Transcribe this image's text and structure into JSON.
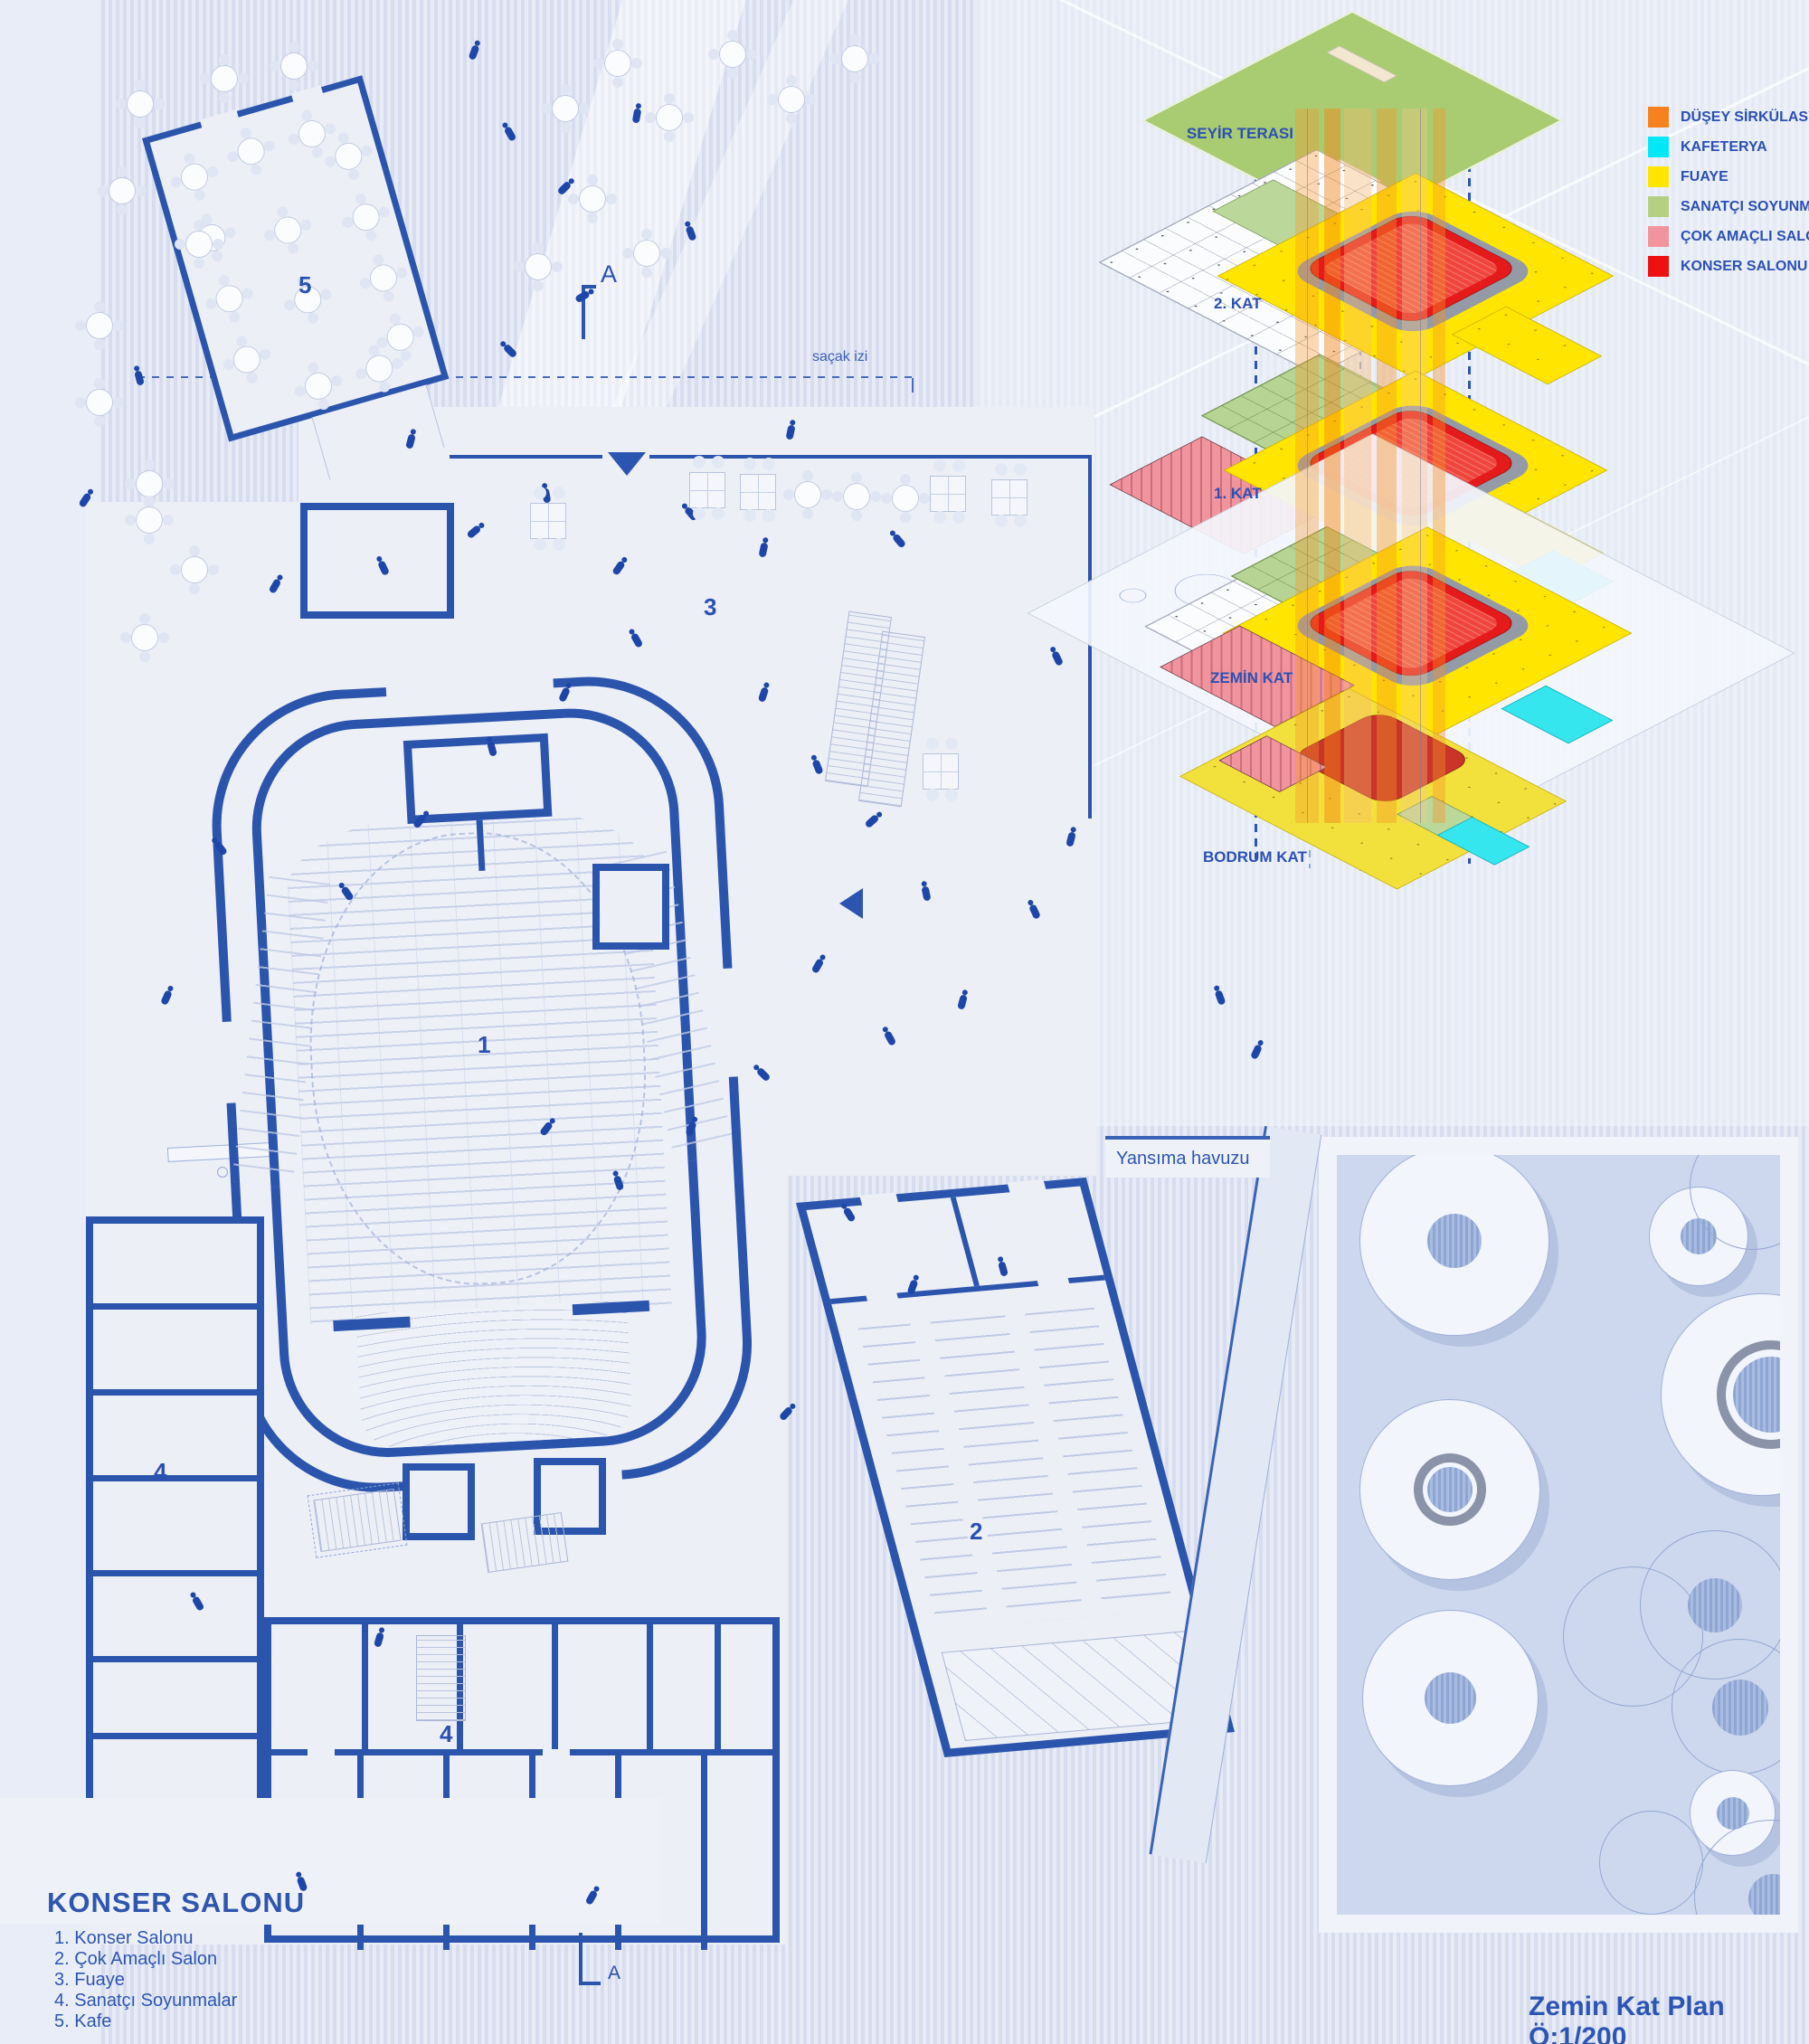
{
  "doc": {
    "scale_title": "Zemin Kat Plan Ö:1/200"
  },
  "plan": {
    "heading": "KONSER SALONU",
    "key_list": [
      "1. Konser Salonu",
      "2. Çok Amaçlı Salon",
      "3. Fuaye",
      "4. Sanatçı Soyunmalar",
      "5. Kafe"
    ],
    "room_numbers": {
      "konser_salonu": "1",
      "cok_amacli_salon": "2",
      "fuaye": "3",
      "soyunma_left": "4",
      "soyunma_bottom": "4",
      "kafe": "5"
    },
    "annotations": {
      "sacak_izi": "saçak izi",
      "yansima_havuzu": "Yansıma havuzu",
      "section_a_top": "A",
      "section_a_bottom": "A"
    }
  },
  "axon": {
    "floor_labels": [
      "SEYİR TERASI",
      "2. KAT",
      "1. KAT",
      "ZEMİN KAT",
      "BODRUM KAT"
    ],
    "legend": [
      {
        "label": "DÜŞEY SİRKÜLASYON",
        "color": "#F5821E"
      },
      {
        "label": "KAFETERYA",
        "color": "#00E8F8"
      },
      {
        "label": "FUAYE",
        "color": "#FFE500"
      },
      {
        "label": "SANATÇI SOYUNMALAR",
        "color": "#B5D083"
      },
      {
        "label": "ÇOK AMAÇLI SALON",
        "color": "#F0949E"
      },
      {
        "label": "KONSER SALONU",
        "color": "#EE1111"
      }
    ]
  },
  "colors": {
    "wall_blue": "#2B55AD",
    "label_blue": "#2B50B4",
    "hall_red": "#E51A1A",
    "foyer_yellow": "#FFE500",
    "terrace_green": "#A9CB72"
  }
}
